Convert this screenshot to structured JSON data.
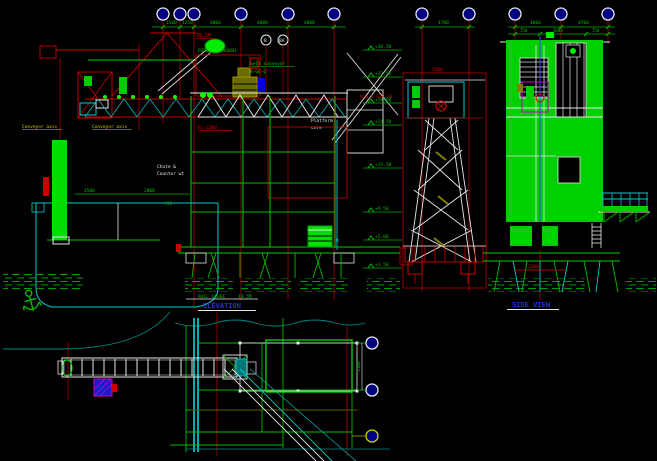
{
  "drawing": {
    "type": "CAD elevation drawing - ship loader at wharf",
    "background": "#000000"
  },
  "titles": {
    "front": "ELEVATION",
    "side": "SIDE VIEW"
  },
  "labels": {
    "conveyor_axis_left": "Conveyor axis",
    "conveyor_axis_right": "Conveyor axis",
    "pipe_note": "PIPE IN TROUGH",
    "belt_line1": "belt conveyor",
    "belt_line2": "B-GE-Q",
    "platform_line1": "Platform",
    "platform_line2": "core",
    "chute_line1": "Chute &",
    "chute_line2": "Counter wt",
    "girder_note": "B1 CONV.",
    "hwl_note": "H.W.L +28.50",
    "top_red_note": "39.5M",
    "deck_gauge_label": "RAIL GAUGE",
    "deck_gauge_value": "10.5M",
    "equipment_m": "M",
    "circle_b": "B",
    "circle_ba": "BA",
    "tower_dim": "2500",
    "side_pile_dim": "2500",
    "plan_dim": "3100"
  },
  "dims": {
    "top_main": [
      "1500",
      "1250",
      "4000",
      "4000",
      "4000"
    ],
    "top_side": [
      "4700",
      "4600",
      "4700"
    ],
    "side_row2": [
      "750",
      "3000",
      "750"
    ],
    "basin": [
      "4500",
      "2000",
      "H11"
    ]
  },
  "elevations": [
    "+38.50",
    "+33.50",
    "+28.50",
    "+24.50",
    "+15.50",
    "+9.50",
    "+5.00",
    "+1.50"
  ],
  "colors": {
    "grid_red": "#cc0000",
    "structure_green": "#00cc00",
    "bright_green": "#00ee00",
    "detail_cyan": "#00cccc",
    "dim_green": "#00aa00",
    "title_blue": "#2233cc",
    "label_yellow": "#cccc00",
    "hatch_magenta": "#cc00cc",
    "bubble_navy": "#000080"
  }
}
